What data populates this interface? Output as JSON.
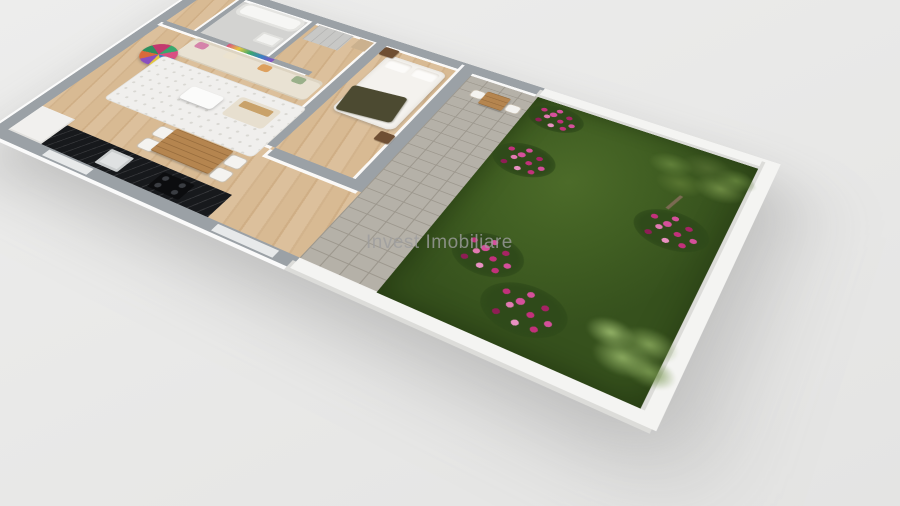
{
  "watermark": {
    "text": "Invest Imobiliare"
  },
  "palette": {
    "background": "#e9e9e8",
    "wall_cap_gray": "#9ba1a6",
    "wall_white": "#f4f4f2",
    "wood_floor": "#d8ba93",
    "concrete_floor": "#d3d3d1",
    "paver_gray": "#b5b1a8",
    "grass_green": "#405e22",
    "countertop_black": "#17191c",
    "sofa_cream": "#e9e2d3",
    "rug_white": "#f0efed",
    "bed_white": "#f4f2ee",
    "throw_olive": "#4c4a31",
    "dining_wood": "#b5854f",
    "nightstand_brown": "#6f4f33",
    "flower_magenta": "#c2317b",
    "flower_pink": "#e27ab2",
    "tree_olive": "#61803a",
    "shrub_light": "#8aa95f",
    "watermark_gray": "#9e9e9e"
  }
}
